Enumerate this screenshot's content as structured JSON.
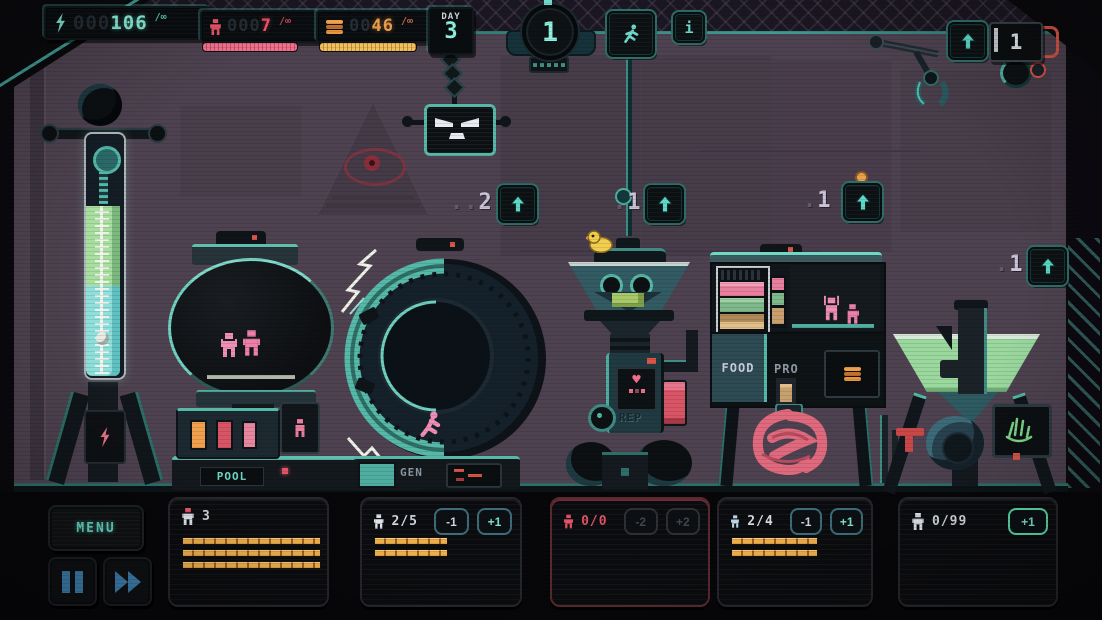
{
  "colors": {
    "accent": "#7fe3d2",
    "energy": "#8df2dc",
    "population": "#f2566e",
    "food": "#f0a04c",
    "bar_orange": "#e8a33c",
    "red": "#e05566",
    "wall": "#4e4250"
  },
  "hud": {
    "energy": {
      "icon": "lightning-icon",
      "pad": "000",
      "value": "106",
      "max": "/∞"
    },
    "population": {
      "icon": "person-icon",
      "pad": "000",
      "value": "7",
      "max": "/∞"
    },
    "food": {
      "icon": "burger-icon",
      "pad": "00",
      "value": "46",
      "max": "/∞"
    },
    "day": {
      "label": "DAY",
      "value": "3"
    },
    "wave": {
      "value": "1"
    },
    "info": {
      "label": "i"
    },
    "crane_counter": {
      "value": "1"
    }
  },
  "icons": {
    "heart": "♥"
  },
  "upgrades": [
    {
      "dots": "..",
      "cost": "2"
    },
    {
      "dots": ".",
      "cost": "1"
    },
    {
      "dots": ".",
      "cost": "1"
    },
    {
      "dots": ".",
      "cost": "1"
    }
  ],
  "machines": {
    "pool": {
      "label": "POOL"
    },
    "generator": {
      "label": "GEN"
    },
    "replicator": {
      "label": "REP"
    },
    "food_processor": {
      "label": "FOOD",
      "label2": "PRO"
    }
  },
  "controls": {
    "menu": "MENU"
  },
  "panels": [
    {
      "count": "3",
      "bars": [
        137,
        137,
        137
      ]
    },
    {
      "count": "2/5",
      "minus": "-1",
      "plus": "+1",
      "bars": [
        72,
        72
      ]
    },
    {
      "count": "0/0",
      "minus": "-2",
      "plus": "+2",
      "bars": []
    },
    {
      "count": "2/4",
      "minus": "-1",
      "plus": "+1",
      "bars": [
        85,
        85
      ]
    },
    {
      "count": "0/99",
      "plus": "+1",
      "bars": []
    }
  ]
}
